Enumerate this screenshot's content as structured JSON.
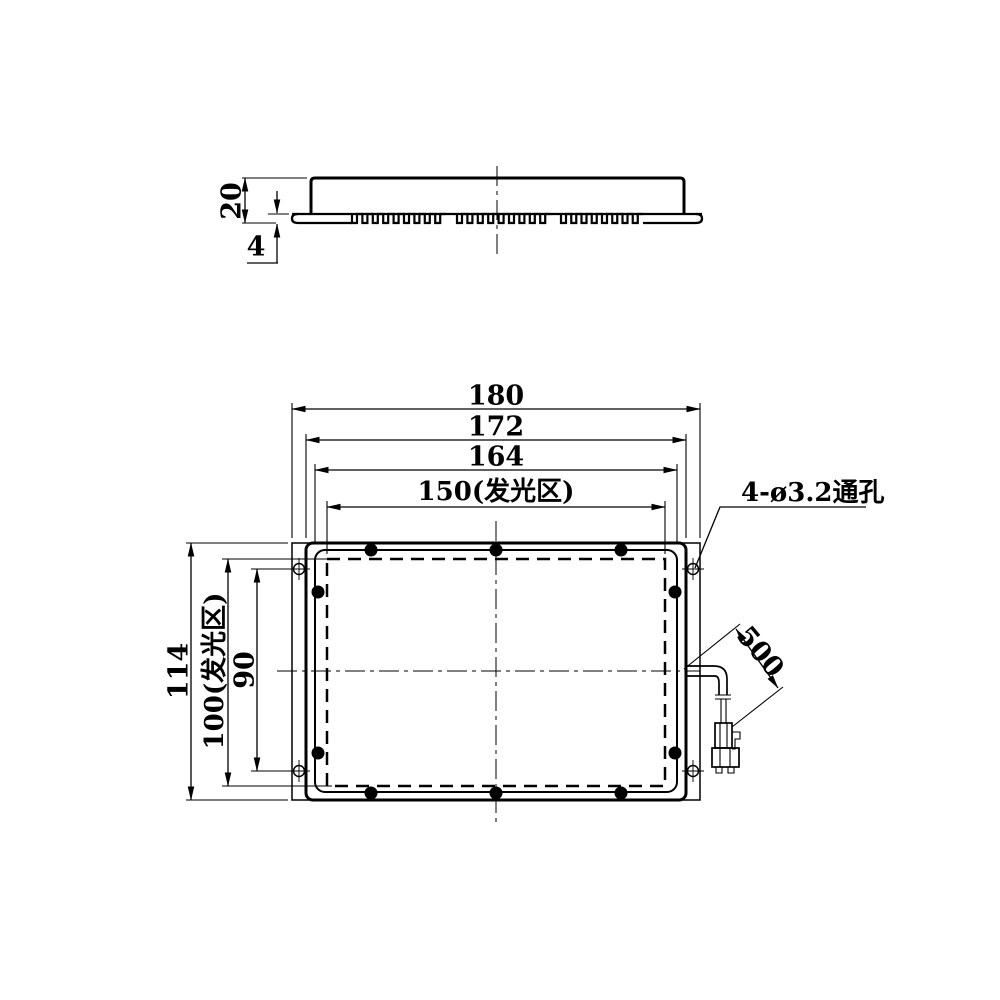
{
  "side_view": {
    "dim_body_height": "20",
    "dim_base_thickness": "4"
  },
  "plan_view": {
    "dim_overall_width": "180",
    "dim_body_width": "172",
    "dim_frame_width": "164",
    "dim_glow_width": "150(发光区)",
    "dim_overall_height": "114",
    "dim_glow_height": "100(发光区)",
    "dim_hole_pitch": "90",
    "mount_hole_note": "4-ø3.2通孔",
    "dim_cable_length": "500"
  },
  "colors": {
    "line": "#000000",
    "background": "#ffffff"
  }
}
